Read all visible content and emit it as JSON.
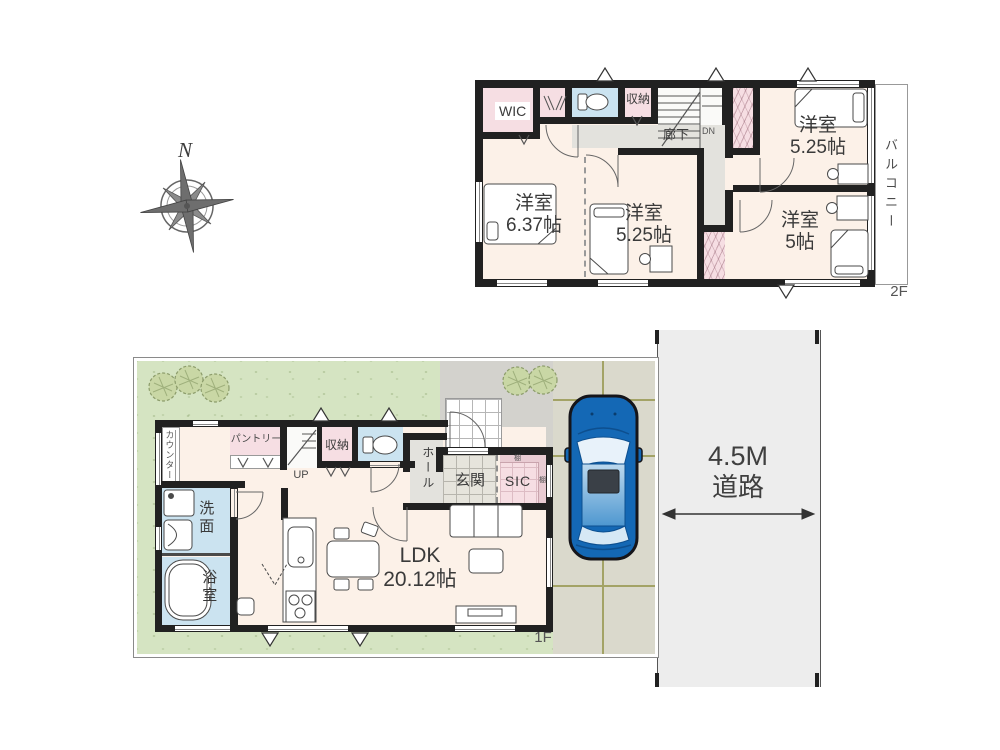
{
  "compass": {
    "north": "N"
  },
  "floor2": {
    "label": "2F",
    "balcony": "バルコニー",
    "hallway": "廊下",
    "stairs_down": "DN",
    "wic": "WIC",
    "storage": "収納",
    "bedroom_left": {
      "type": "洋室",
      "area": "6.37帖"
    },
    "bedroom_middle": {
      "type": "洋室",
      "area": "5.25帖"
    },
    "bedroom_top_right": {
      "type": "洋室",
      "area": "5.25帖"
    },
    "bedroom_right": {
      "type": "洋室",
      "area": "5帖"
    }
  },
  "floor1": {
    "label": "1F",
    "counter": "カウンター",
    "pantry": "パントリー",
    "stairs_up": "UP",
    "storage": "収納",
    "hall": "ホール",
    "entrance": "玄関",
    "shoe_closet": "SIC",
    "shelf_top": "棚",
    "shelf_side": "棚",
    "washroom": "洗面",
    "bathroom": "浴室",
    "ldk": {
      "type": "LDK",
      "area": "20.12帖"
    }
  },
  "road": {
    "width_label": "4.5M",
    "name": "道路"
  },
  "colors": {
    "wall": "#212121",
    "room_cream": "#fcf1e8",
    "closet_pink": "#f6dee3",
    "wet_area_blue": "#cbe3f0",
    "hall_gray": "#e3e2dd",
    "lawn_green": "#d5e4c2",
    "concrete": "#d3d2cd",
    "driveway": "#dad9cc",
    "road_gray": "#ededed",
    "car_blue": "#1468b5"
  }
}
